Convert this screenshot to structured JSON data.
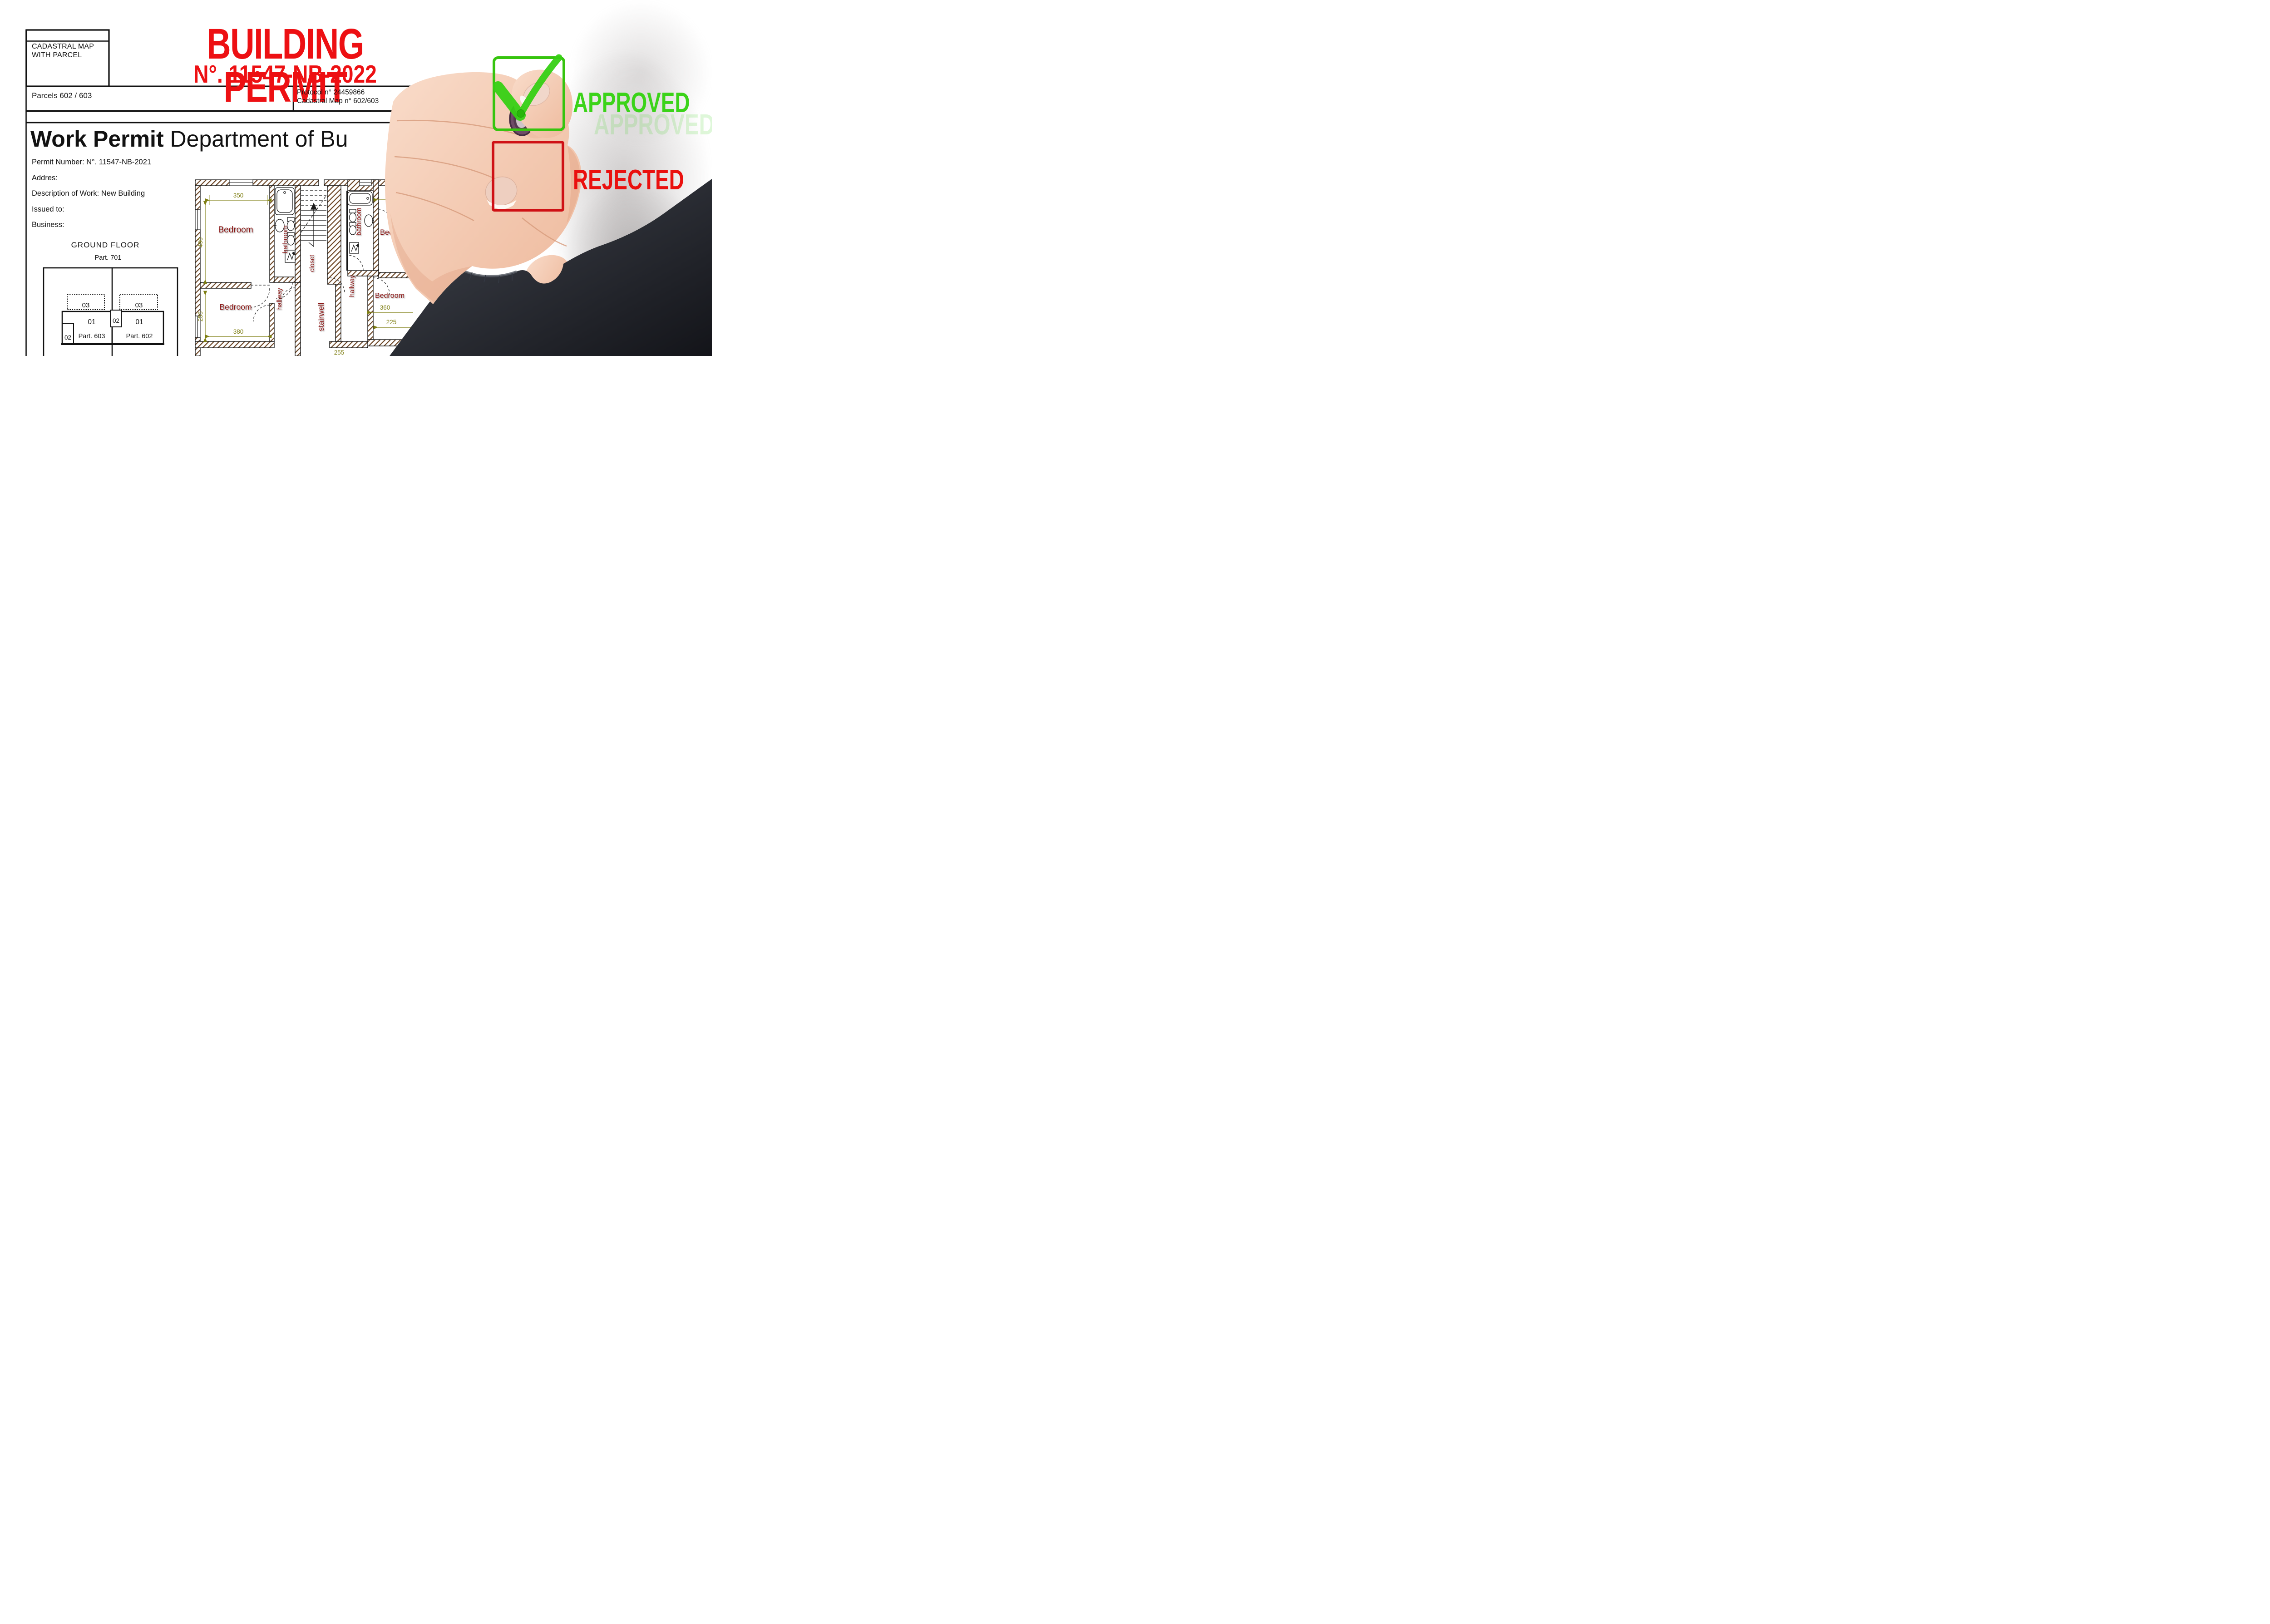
{
  "document": {
    "cadastral_box": {
      "line1": "CADASTRAL MAP",
      "line2": "WITH PARCEL"
    },
    "title": "BUILDING PERMIT",
    "title_number": "N°. 11547-NB-2022",
    "parcels_line": "Parcels 602 / 603",
    "protocol": {
      "line1_left": "Protocol n° 24459866",
      "line1_right": "of 11/",
      "line2": "Cadastral Map n° 602/603"
    },
    "heading": {
      "bold": "Work Permit",
      "rest": " Department of Bu"
    },
    "details": [
      "Permit Number: N°. 11547-NB-2021",
      "Addres:",
      "Description of Work: New Building",
      "Issued to:",
      "Business:"
    ],
    "ground_floor": {
      "title": "GROUND FLOOR",
      "subtitle": "Part. 701",
      "labels": {
        "dotted_left": "03",
        "dotted_right": "03",
        "left_unit": "01",
        "left_parcel": "Part. 603",
        "right_unit": "01",
        "right_parcel": "Part. 602",
        "left_small": "02",
        "center_small": "02"
      }
    }
  },
  "floor_plan": {
    "labels": {
      "bedroom_top_left": "Bedroom",
      "bathroom_left": "bathroom",
      "closet": "closet",
      "hallway_left": "hallway",
      "stairwell": "stairwell",
      "hallway_right": "hallway",
      "bathroom_right": "bathroom",
      "bedroom_top_right": "Bedroom",
      "bedroom_bottom_right": "Bedroom",
      "bedroom_bottom_left": "Bedroom"
    },
    "dimensions": {
      "d350": "350",
      "d490": "490",
      "d255": "255",
      "d380": "380",
      "d360": "360",
      "d225": "225",
      "d255b": "255"
    }
  },
  "stamps": {
    "approved": "APPROVED",
    "approved_ghost": "APPROVED",
    "rejected": "REJECTED"
  },
  "colors": {
    "title_red": "#ed1013",
    "plan_label": "#8a1713",
    "plan_dim": "#7e7e12",
    "hatch": "#6b4423",
    "approved": "#3bd319",
    "rejected": "#ea100e",
    "checkbox_green": "#36c40e",
    "checkbox_red": "#cf1115"
  }
}
